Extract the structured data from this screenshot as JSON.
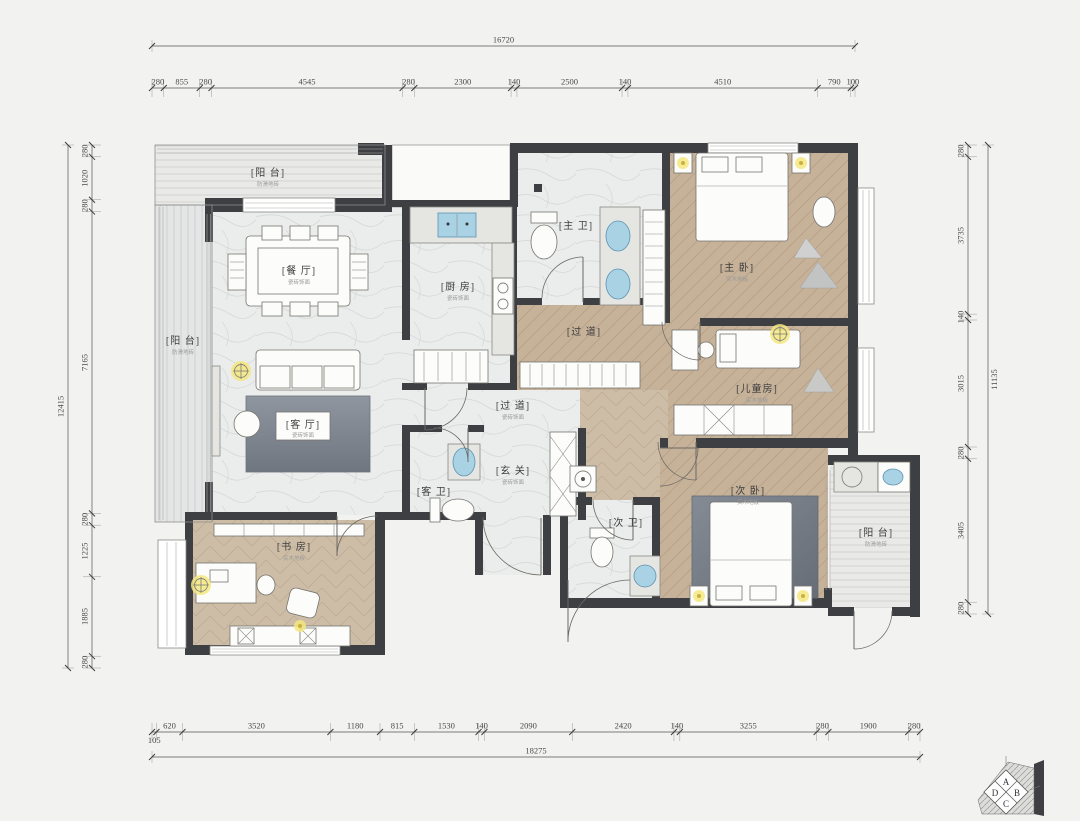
{
  "canvas": {
    "bg": "#f2f2f0",
    "wall_color": "#3e3f43",
    "wood_color": "#c6b199",
    "marble_color": "#ebecec",
    "fixture_blue": "#a9d2e4",
    "lamp_yellow": "#f4e87f"
  },
  "rooms": {
    "balcony_tl": {
      "label": "[阳 台]",
      "sub": "防滑地砖"
    },
    "balcony_left": {
      "label": "[阳 台]",
      "sub": "防滑地砖"
    },
    "dining": {
      "label": "[餐 厅]",
      "sub": "瓷砖饰面"
    },
    "kitchen": {
      "label": "[厨 房]",
      "sub": "瓷砖饰面"
    },
    "master_bath": {
      "label": "[主 卫]"
    },
    "hall_upper": {
      "label": "[过 道]"
    },
    "master_bed": {
      "label": "[主 卧]",
      "sub": "实木地板"
    },
    "kids": {
      "label": "[儿童房]",
      "sub": "实木地板"
    },
    "living": {
      "label": "[客 厅]",
      "sub": "瓷砖饰面"
    },
    "hall_lower": {
      "label": "[过 道]",
      "sub": "瓷砖饰面"
    },
    "foyer": {
      "label": "[玄 关]",
      "sub": "瓷砖饰面"
    },
    "guest_bath": {
      "label": "[客 卫]"
    },
    "second_bath": {
      "label": "[次 卫]"
    },
    "second_bed": {
      "label": "[次 卧]",
      "sub": "实木地板"
    },
    "study": {
      "label": "[书 房]",
      "sub": "实木地板"
    },
    "balcony_right": {
      "label": "[阳 台]",
      "sub": "防滑地砖"
    }
  },
  "dimensions": {
    "top": {
      "total": "16720",
      "segments": [
        "280",
        "855",
        "280",
        "4545",
        "280",
        "2300",
        "140",
        "2500",
        "140",
        "4510",
        "790",
        "100"
      ]
    },
    "bottom": {
      "total": "18275",
      "segments": [
        "105",
        "620",
        "3520",
        "1180",
        "815",
        "1530",
        "140",
        "2090",
        "2420",
        "140",
        "3255",
        "280",
        "1900",
        "280"
      ]
    },
    "left": {
      "total": "12415",
      "segments": [
        "280",
        "1020",
        "280",
        "7165",
        "280",
        "1225",
        "1885",
        "280"
      ]
    },
    "right": {
      "total": "11135",
      "segments": [
        "280",
        "3735",
        "140",
        "3015",
        "280",
        "3405",
        "280"
      ]
    }
  },
  "compass": {
    "a": "A",
    "b": "B",
    "c": "C",
    "d": "D"
  }
}
